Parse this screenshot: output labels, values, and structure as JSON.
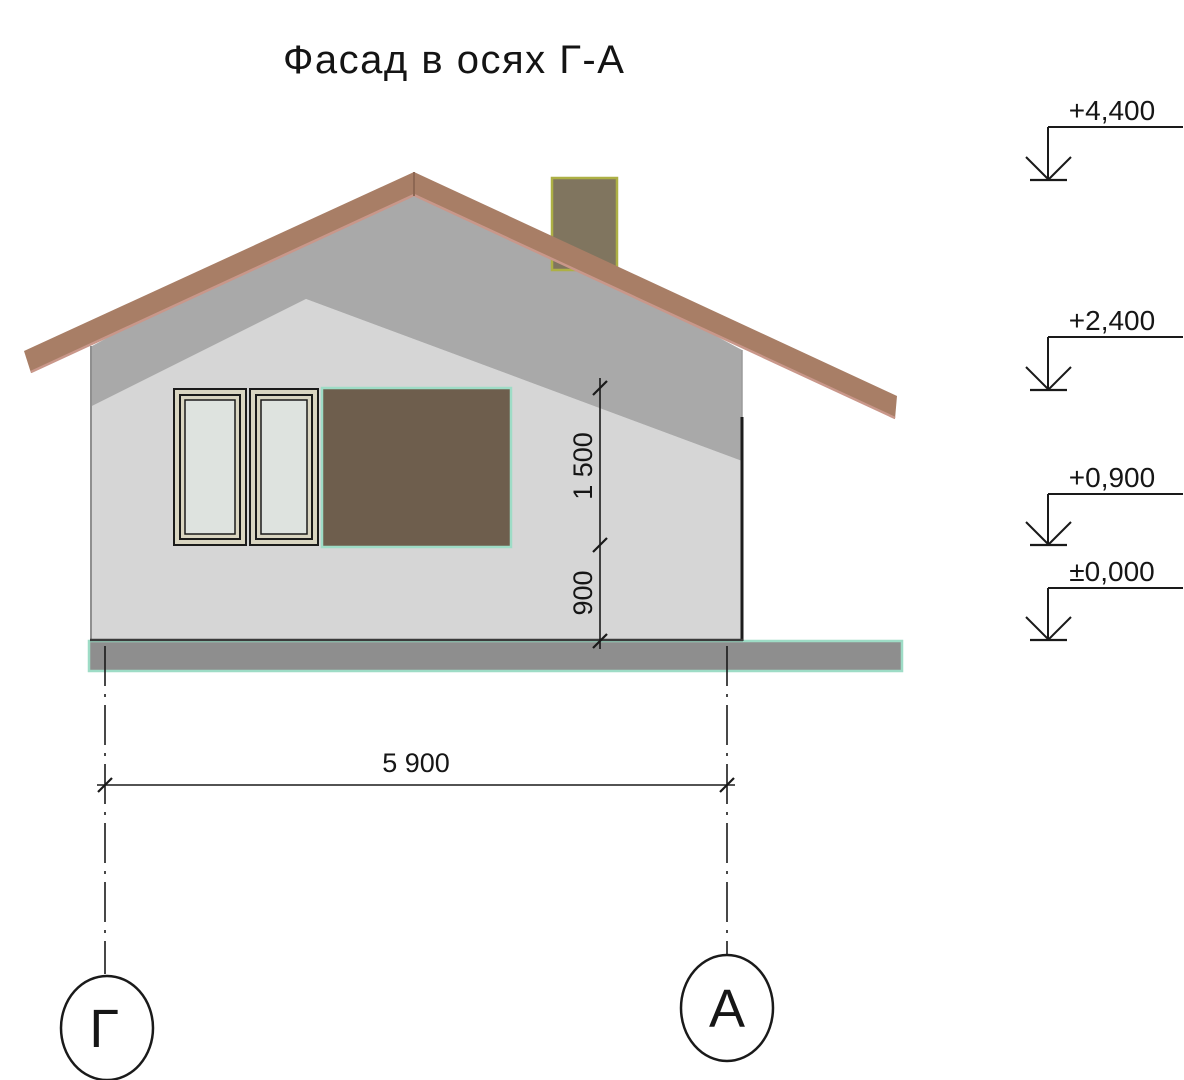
{
  "title": "Фасад в осях Г-А",
  "dimensions": {
    "window_height": "1 500",
    "sill_height": "900",
    "building_width": "5 900"
  },
  "elevation_marks": [
    {
      "value": "+4,400"
    },
    {
      "value": "+2,400"
    },
    {
      "value": "+0,900"
    },
    {
      "value": "±0,000"
    }
  ],
  "axes": [
    {
      "label": "Г"
    },
    {
      "label": "А"
    }
  ],
  "colors": {
    "roof": "#a87e66",
    "roof_edge": "#c9978a",
    "roof_ridge": "#8d6753",
    "gable_shadow": "#a9a9a9",
    "wall": "#d6d6d6",
    "chimney": "#80755f",
    "chimney_border": "#adb045",
    "window_frame": "#d9d5c1",
    "window_glass": "#dee3df",
    "opening": "#6e5e4d",
    "accent_mint": "#9edcc6",
    "ground": "#8e8e8e"
  }
}
